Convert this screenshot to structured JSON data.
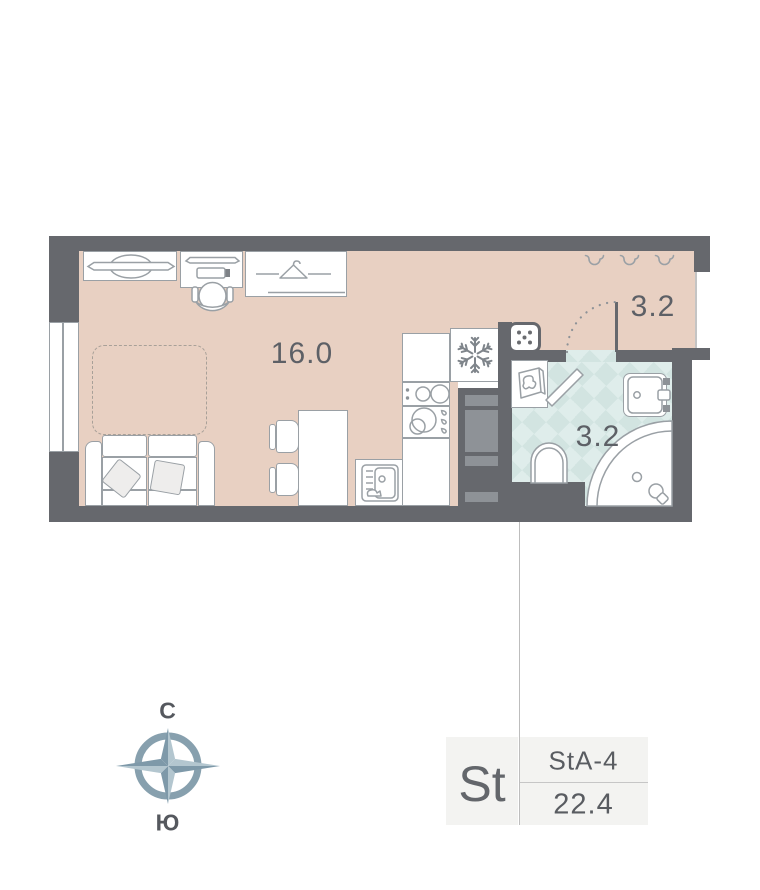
{
  "plan": {
    "rooms": {
      "living_area": "16.0",
      "hall_area": "3.2",
      "bath_area": "3.2"
    }
  },
  "compass": {
    "north": "С",
    "south": "Ю"
  },
  "unit_card": {
    "type_code": "St",
    "plan_code": "StA-4",
    "total_area": "22.4"
  },
  "colors": {
    "wall": "#66686d",
    "floor": "#e8d0c2",
    "tile": "#dfedeb",
    "tile_check": "#d2e4e1",
    "line": "#9aa0a5",
    "inner_gray": "#8e9297",
    "text": "#5d6066",
    "card_bg": "#f3f3f1",
    "leader": "#bdbdbd",
    "dash": "#a8a098",
    "compass_dark": "#7e99a9",
    "compass_light": "#b3c6cf",
    "compass_ring": "#87a0ae"
  }
}
